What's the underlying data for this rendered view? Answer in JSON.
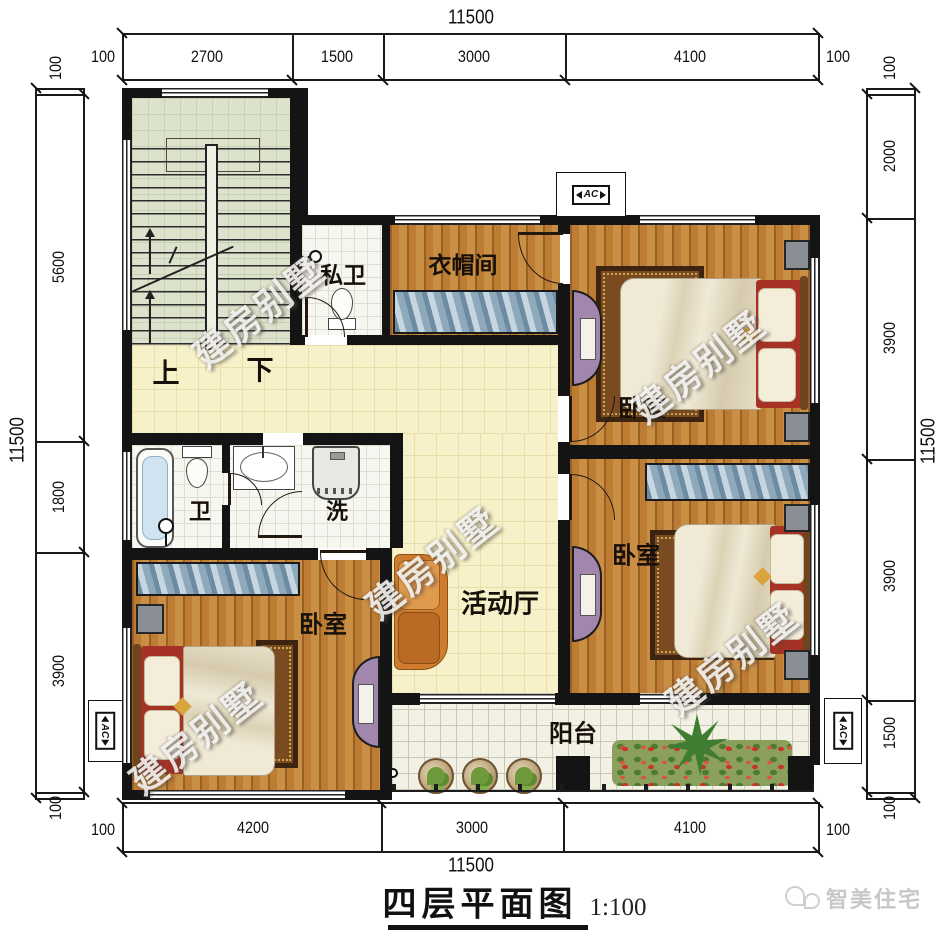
{
  "title": {
    "text": "四层平面图",
    "scale": "1:100"
  },
  "logo": {
    "text": "智美住宅"
  },
  "watermark": {
    "text": "建房别墅"
  },
  "ac": {
    "label": "AC"
  },
  "rooms": {
    "stair_up": "上",
    "stair_down": "下",
    "private_bath": "私卫",
    "cloakroom": "衣帽间",
    "bedroom_top_right": "卧室",
    "bedroom_bottom_right": "卧室",
    "bedroom_bottom_left": "卧室",
    "bath": "卫",
    "laundry": "洗",
    "hall": "活动厅",
    "balcony": "阳台"
  },
  "dimensions": {
    "top": {
      "overall": "11500",
      "segments": [
        "100",
        "2700",
        "1500",
        "3000",
        "4100",
        "100"
      ]
    },
    "bottom": {
      "overall": "11500",
      "segments": [
        "100",
        "4200",
        "3000",
        "4100",
        "100"
      ]
    },
    "left": {
      "overall": "11500",
      "segments": [
        "100",
        "5600",
        "1800",
        "3900",
        "100"
      ]
    },
    "right": {
      "overall": "11500",
      "segments": [
        "100",
        "2000",
        "3900",
        "3900",
        "1500",
        "100"
      ]
    }
  },
  "colors": {
    "wall": "#141414",
    "wood_floor": "#bd7c33",
    "hall_floor": "#f6f1c9",
    "stair_floor": "#dce2cb",
    "tile_floor": "#f7f7f1",
    "wardrobe_blue": "#9db6c8",
    "cabinet_purple": "#a287ad",
    "sofa_orange": "#cf7c2e",
    "bed_red": "#a63226",
    "plant_green": "#6e9a3c",
    "flower_red": "#cc3322"
  }
}
